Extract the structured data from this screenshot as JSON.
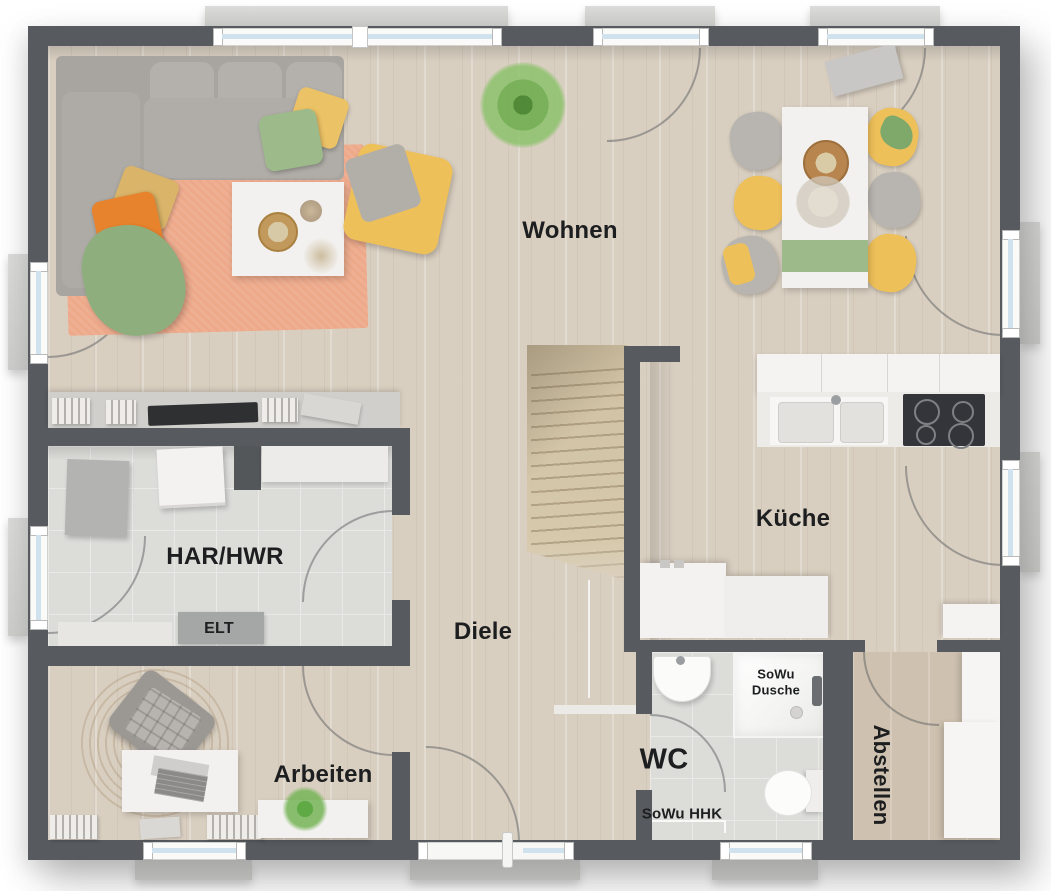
{
  "plan": {
    "rooms": {
      "wohnen": {
        "label": "Wohnen"
      },
      "kueche": {
        "label": "Küche"
      },
      "diele": {
        "label": "Diele"
      },
      "har_hwr": {
        "label": "HAR/HWR"
      },
      "arbeiten": {
        "label": "Arbeiten"
      },
      "wc": {
        "label": "WC"
      },
      "abstellen": {
        "label": "Abstellen"
      }
    },
    "annotations": {
      "elt": "ELT",
      "sowu_dusche": "SoWu Dusche",
      "sowu_hhk": "SoWu HHK"
    },
    "colors": {
      "wall": "#575b5f",
      "floor": "#d9cfc1",
      "floor_dark": "#cec1af",
      "tile": "#dcdcd9",
      "glass": "#cfe2ed",
      "sill": "#cfcfcd",
      "rug": "#eda98a",
      "sofa": "#a8a5a1",
      "yellow": "#eec05a",
      "green": "#9dbb8a",
      "orange": "#e8832d",
      "stairs": "#d8cbae",
      "white_furn": "#f2f1ef",
      "jute": "#c5a77c",
      "label": "#1d1e20"
    }
  }
}
